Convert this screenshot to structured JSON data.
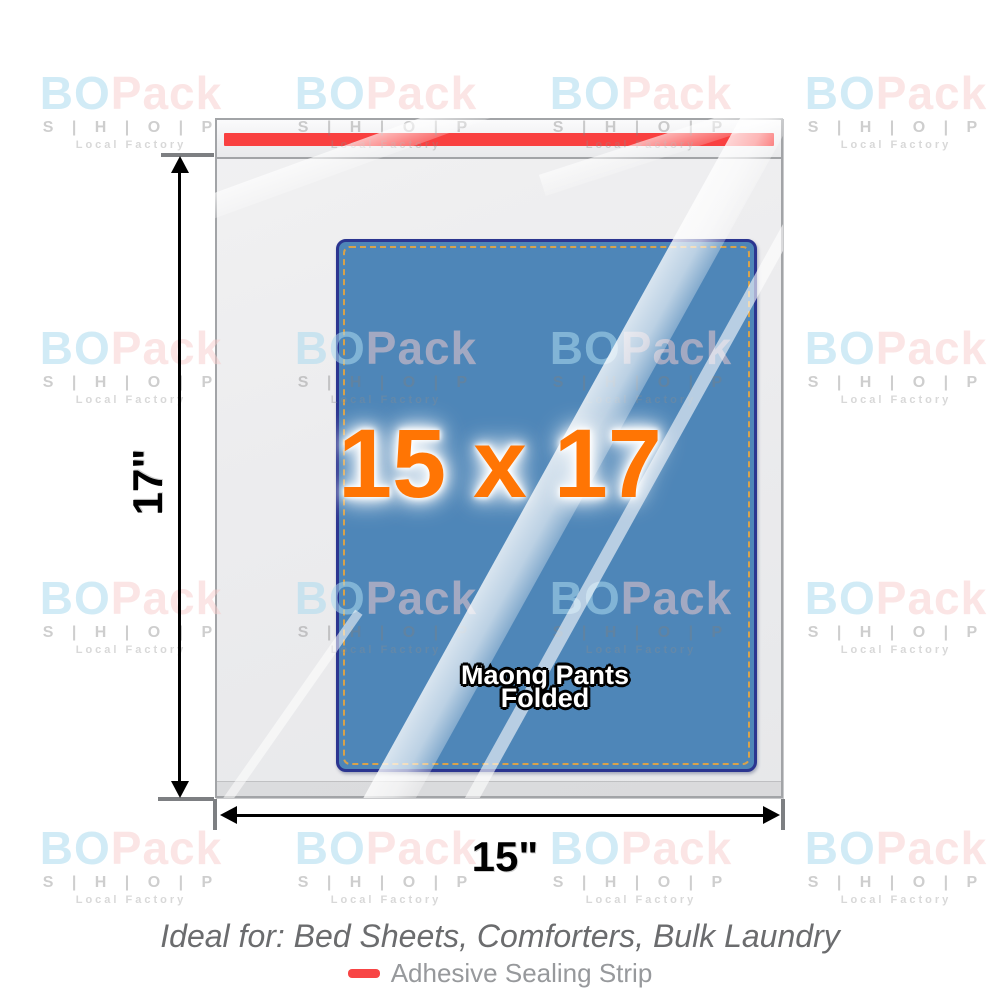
{
  "product": {
    "size_text": "15 x 17",
    "width_label": "15\"",
    "height_label": "17\"",
    "content_marks": "▲▲",
    "content_line1": "Maong Pants",
    "content_line2": "Folded"
  },
  "caption": "Ideal for: Bed Sheets, Comforters, Bulk Laundry",
  "legend": {
    "label": "Adhesive Sealing Strip",
    "swatch_color": "#f84545"
  },
  "watermark": {
    "brand_bo": "BO",
    "brand_pack": "Pack",
    "shop": "S | H | O | P",
    "factory": "Local Factory"
  },
  "colors": {
    "seal_strip": "#f94040",
    "bag_border": "#a2a4a7",
    "contents_fill": "#4e86b8",
    "contents_border": "#2b3590",
    "contents_stitch": "#d8a24a",
    "size_text": "#ff7504"
  }
}
